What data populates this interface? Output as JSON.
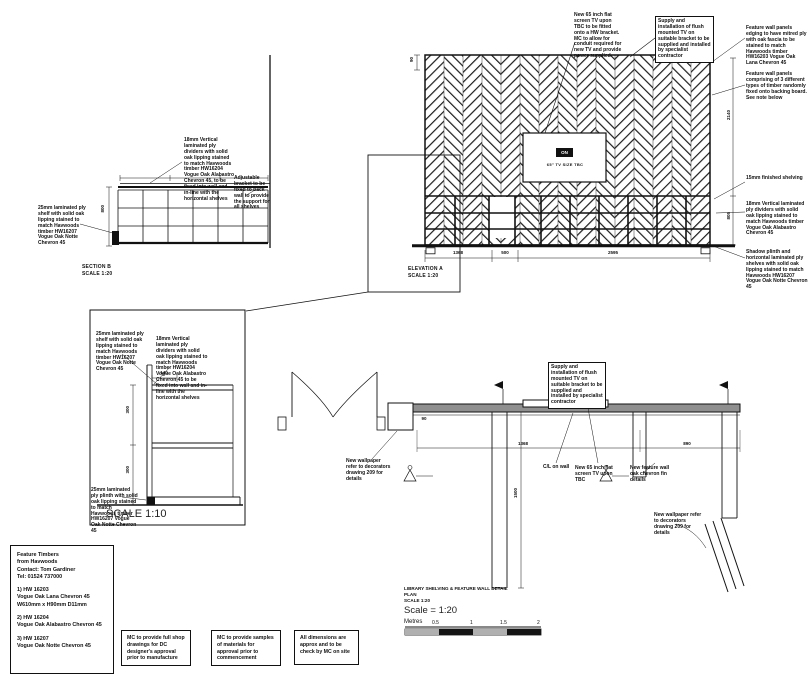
{
  "section_b": {
    "title": "SECTION B",
    "scale": "SCALE 1:20",
    "ann_vertical": "18mm Vertical laminated ply dividers with solid oak lipping stained to match Havwoods timber HW16204 Vogue Oak Alabastro Chevron 45, to be fixed into wall and in-line with the horizontal shelves",
    "ann_bracket": "Adjustable bracket to be fixed to back wall to provide the support for all shelves",
    "ann_shelf": "25mm laminated ply shelf with solid oak lipping stained to match Havwoods timber HW16207 Vogue Oak Notte Chevron 45",
    "dim_height": "800"
  },
  "elevation_a": {
    "title": "ELEVATION A",
    "scale": "SCALE 1:20",
    "tv_badge": "ON",
    "tv_caption": "65\" TV SIZE TBC",
    "ann_tv": "New 65 inch flat screen TV upon TBC to be fitted onto a HW bracket. MC to allow for conduit required for new TV and provide power supplied",
    "ann_supply": "Supply and installation of flush mounted TV on suitable bracket to be supplied and installed by specialist contractor",
    "ann_right_1": "Feature wall panels edging to have mitred ply with oak fascia to be stained to match Havwoods timber HW16203 Vogue Oak Lana Chevron 45",
    "ann_right_2": "Feature wall panels comprising of 3 different types of timber randomly fixed onto backing board. See note below",
    "ann_right_3": "15mm finished shelving",
    "ann_right_4": "18mm Vertical laminated ply dividers with solid oak lipping stained to match Havwoods timber Vogue Oak Alabastro Chevron 45",
    "ann_right_5": "Shadow plinth and horizontal laminated ply shelves with solid oak lipping stained to match Havwoods HW16207 Vogue Oak Notte Chevron 45",
    "dim_bottom_1": "1368",
    "dim_bottom_2": "500",
    "dim_bottom_3": "2595",
    "dim_right_upper": "2140",
    "dim_right_lower": "805",
    "dim_left_top": "90"
  },
  "detail": {
    "scale_label": "SCALE 1:10",
    "ann_shelf": "25mm laminated ply shelf with solid oak lipping stained to match Havwoods timber HW16207 Vogue Oak Notte Chevron 45",
    "ann_vertical": "18mm Vertical laminated ply dividers with solid oak lipping stained to match Havwoods timber HW16204 Vogue Oak Alabastro Chevron 45 to be fixed into wall and in-line with the horizontal shelves",
    "ann_plinth": "25mm laminated ply plinth with solid oak lipping stained to match Havwoods timber HW16207 Vogue Oak Notte Chevron 45",
    "dim_top": "140",
    "dim_mid": "300",
    "dim_low": "300"
  },
  "plan": {
    "title_line1": "LIBRARY SHELVING & FEATURE WALL DETAIL",
    "title_line2": "PLAN",
    "scale_small": "SCALE 1:20",
    "scale_big": "Scale = 1:20",
    "metres_label": "Metres",
    "tick_1": "0.5",
    "tick_2": "1",
    "tick_3": "1.5",
    "tick_4": "2",
    "ann_wallpaper_1": "New wallpaper refer to decorators drawing 209 for details",
    "ann_centreline": "C/L on wall",
    "ann_tv": "New 65 inch flat screen TV upon TBC",
    "ann_fins": "New feature wall oak chevron fin details",
    "ann_wallpaper_2": "New wallpaper refer to decorators drawing 209 for details",
    "ann_supply": "Supply and installation of flush mounted TV on suitable bracket to be supplied and installed by specialist contractor",
    "dim_1": "1368",
    "dim_2": "890",
    "dim_wall": "1500",
    "dim_small": "90"
  },
  "feature_timbers": {
    "line1": "Feature Timbers",
    "line2": "from Havwoods",
    "line3": "Contact: Tom Gardiner",
    "line4": "Tel: 01524 737000",
    "item1_ref": "1) HW 16203",
    "item1_name": "Vogue Oak Lana Chevron 45",
    "item1_size": "W610mm x H90mm D11mm",
    "item2_ref": "2) HW 16204",
    "item2_name": "Vogue Oak Alabastro Chevron 45",
    "item3_ref": "3) HW 16207",
    "item3_name": "Vogue Oak Notte Chevron 45"
  },
  "notes": {
    "note_1": "MC to provide full shop drawings for DC designer's approval prior to manufacture",
    "note_2": "MC to provide samples of materials for approval prior to commencement",
    "note_3": "All dimensions are approx and to be check by MC on site"
  }
}
